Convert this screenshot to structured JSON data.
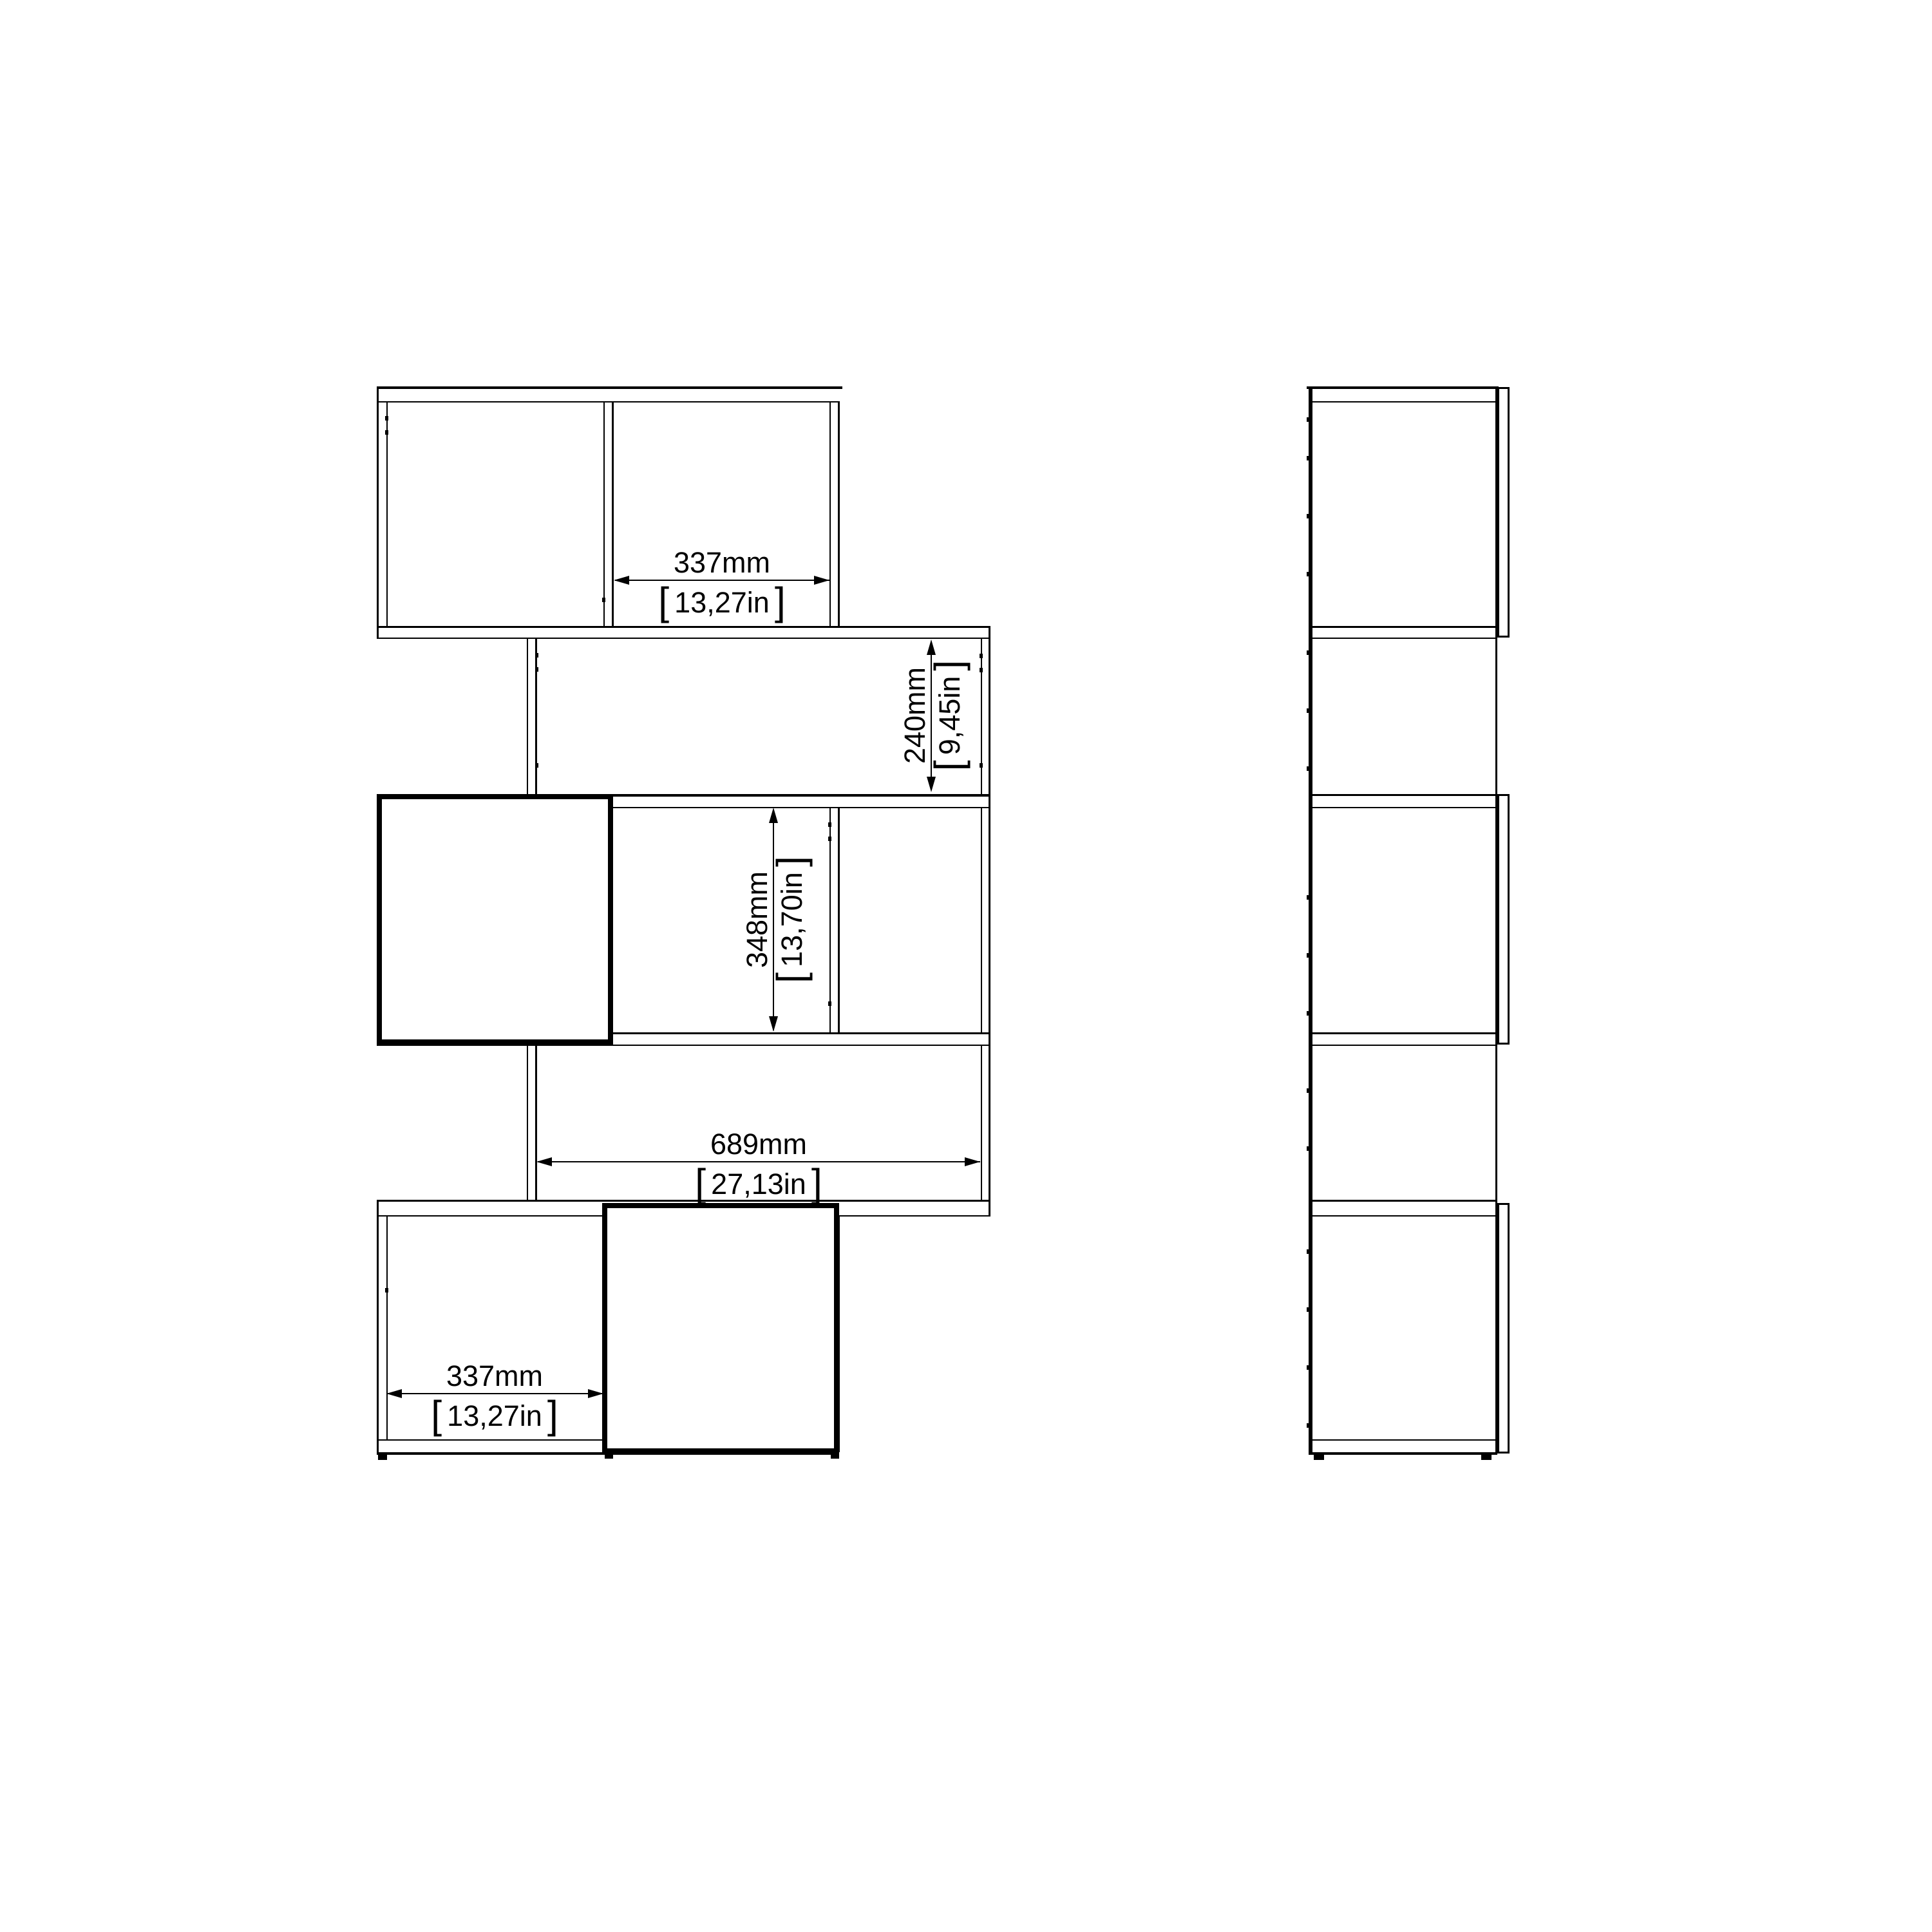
{
  "colors": {
    "background": "#ffffff",
    "line": "#000000"
  },
  "views": {
    "front": {
      "label": "front-elevation-zigzag-bookcase"
    },
    "side": {
      "label": "side-elevation-zigzag-bookcase"
    }
  },
  "brackets": {
    "open": "[",
    "close": "]"
  },
  "dimensions": {
    "top_cell_width": {
      "mm": "337mm",
      "inches": "13,27in"
    },
    "row2_opening_height": {
      "mm": "240mm",
      "inches": "9,45in"
    },
    "row3_opening_height": {
      "mm": "348mm",
      "inches": "13,70in"
    },
    "row4_opening_width": {
      "mm": "689mm",
      "inches": "27,13in"
    },
    "bottom_cell_width": {
      "mm": "337mm",
      "inches": "13,27in"
    }
  }
}
